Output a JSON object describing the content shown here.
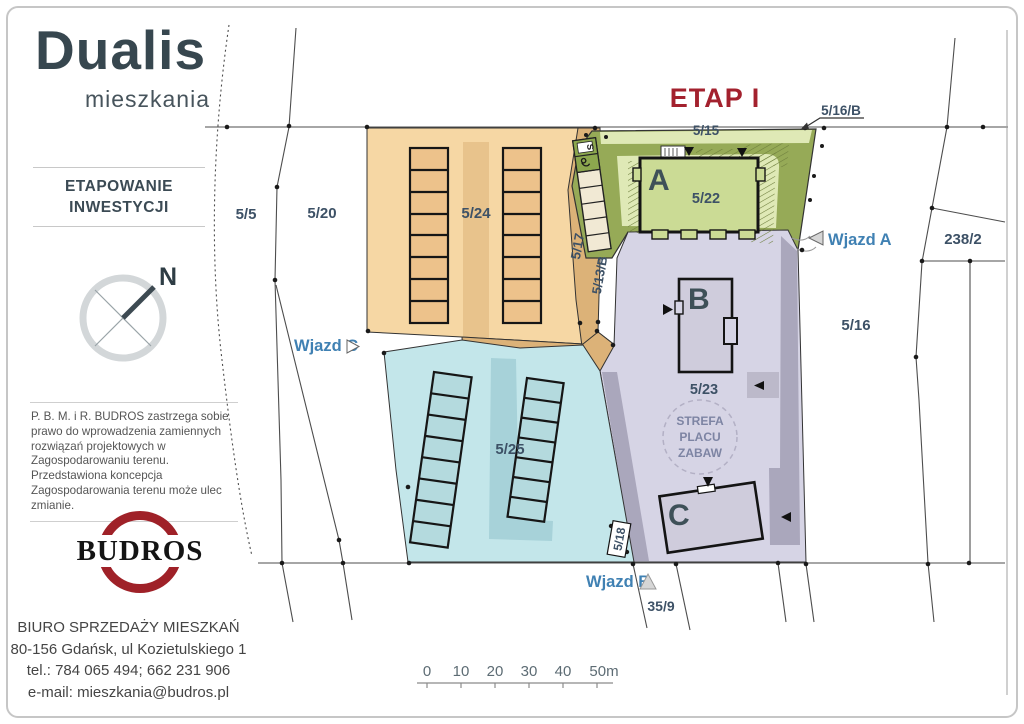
{
  "branding": {
    "title": "Dualis",
    "subtitle": "mieszkania",
    "section_line1": "ETAPOWANIE",
    "section_line2": "INWESTYCJI",
    "compass_n": "N"
  },
  "disclaimer": "P. B. M. i R. BUDROS zastrzega sobie prawo do wprowadzenia zamiennych rozwiązań projektowych w Zagospodarowaniu terenu. Przedstawiona koncepcja Zagospodarowania terenu może ulec zmianie.",
  "budros_logo": "BUDROS",
  "contact": {
    "line1": "BIURO SPRZEDAŻY MIESZKAŃ",
    "line2": "80-156 Gdańsk, ul Kozietulskiego 1",
    "line3": "tel.: 784 065 494; 662 231 906",
    "line4": "e-mail: mieszkania@budros.pl"
  },
  "plan": {
    "stage_title": "ETAP I",
    "buildings": {
      "a": "A",
      "b": "B",
      "c": "C"
    },
    "parcels": {
      "p5": "5/5",
      "p20": "5/20",
      "p24": "5/24",
      "p25": "5/25",
      "p22": "5/22",
      "p23": "5/23",
      "p15": "5/15",
      "p16": "5/16",
      "p16b": "5/16/B",
      "p17": "5/17",
      "p13b": "5/13/B",
      "p18": "5/18",
      "p238": "238/2",
      "p35": "35/9"
    },
    "entrances": {
      "a": "Wjazd A",
      "b": "Wjazd B",
      "c": "Wjazd C"
    },
    "playground": [
      "STREFA",
      "PLACU",
      "ZABAW"
    ],
    "parking_sign": "S",
    "colors": {
      "orange": "#f6d7a4",
      "orangeDark": "#dcb278",
      "orangeGarage": "#edc28b",
      "olive": "#96aa57",
      "greenLight": "#dfe9b6",
      "greenBldg": "#cbdb95",
      "cyan": "#c3e6ea",
      "cyanDark": "#a7d2d9",
      "cyanGarage": "#b4dade",
      "purple": "#d6d4e5",
      "purplePath": "#aaa7bc",
      "bldgGray": "#cfccdc",
      "label": "#3d5166",
      "blue": "#4081b3",
      "red": "#a3212e",
      "brand": "#37474f",
      "budros": "#9f2128",
      "line": "#4d4d4d"
    }
  },
  "scalebar": {
    "ticks": [
      "0",
      "10",
      "20",
      "30",
      "40",
      "50m"
    ]
  }
}
